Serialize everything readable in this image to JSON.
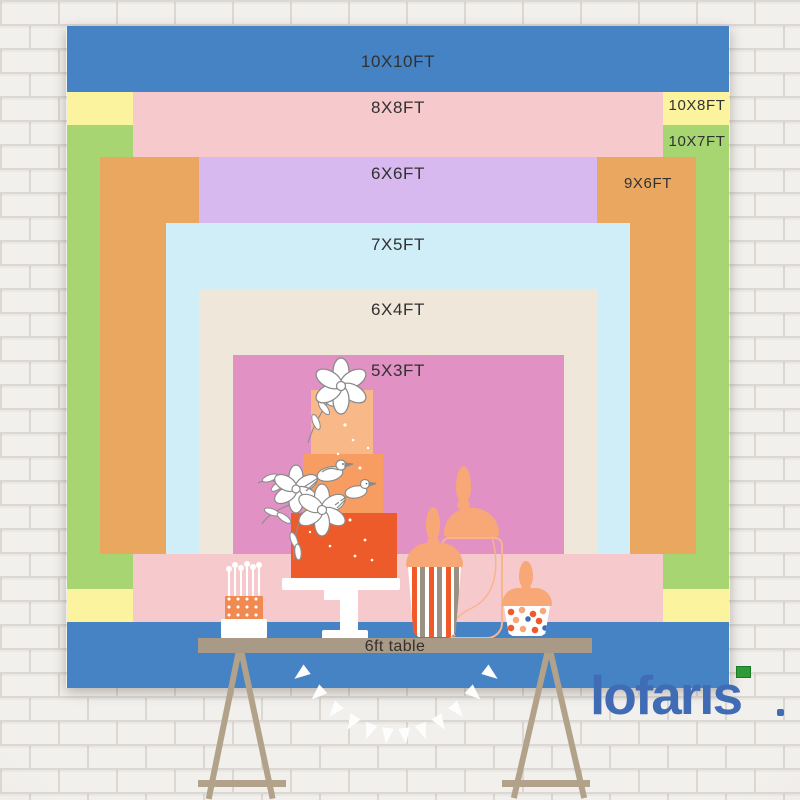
{
  "backdrops": [
    {
      "label": "10X10FT",
      "width_ft": 10,
      "height_ft": 10,
      "color": "#4583c5",
      "v": "center",
      "placement": "center",
      "label_top": 27
    },
    {
      "label": "10X8FT",
      "width_ft": 10,
      "height_ft": 8,
      "color": "#fbf39e",
      "v": "center",
      "placement": "right",
      "label_cx": 631,
      "label_top": 72
    },
    {
      "label": "10X7FT",
      "width_ft": 10,
      "height_ft": 7,
      "color": "#a7d571",
      "v": "center",
      "placement": "right",
      "label_cx": 631,
      "label_top": 108
    },
    {
      "label": "8X8FT",
      "width_ft": 8,
      "height_ft": 8,
      "color": "#f6c9cc",
      "v": "center",
      "placement": "center",
      "label_top": 73
    },
    {
      "label": "9X6FT",
      "width_ft": 9,
      "height_ft": 6,
      "color": "#eaa75f",
      "v": "floor",
      "placement": "right",
      "label_cx": 582,
      "label_top": 150
    },
    {
      "label": "6X6FT",
      "width_ft": 6,
      "height_ft": 6,
      "color": "#d8b9ef",
      "v": "floor",
      "placement": "center",
      "label_top": 139
    },
    {
      "label": "7X5FT",
      "width_ft": 7,
      "height_ft": 5,
      "color": "#cfeef8",
      "v": "floor",
      "placement": "center",
      "label_top": 210
    },
    {
      "label": "6X4FT",
      "width_ft": 6,
      "height_ft": 4,
      "color": "#efe7d9",
      "v": "floor",
      "placement": "center",
      "label_top": 275
    },
    {
      "label": "5X3FT",
      "width_ft": 5,
      "height_ft": 3,
      "color": "#e291c4",
      "v": "floor",
      "placement": "center",
      "label_top": 336
    }
  ],
  "table": {
    "label": "6ft table"
  },
  "brand": {
    "logo_text": "lofaris",
    "logo_color": "#3f6cb5",
    "accent_color": "#2f9b38"
  },
  "colors": {
    "wall_brick": "#f2f0ed",
    "wall_mortar": "#dcd7d2",
    "table_top": "#a89a86",
    "table_legs": "#b2a28a",
    "cake_tier_top": "#f9b888",
    "cake_tier_mid": "#f89d62",
    "cake_tier_bottom": "#ee5b2b",
    "jar_lid_peach": "#f8a777",
    "stripe_orange": "#f05a28",
    "stripe_gray": "#9b9182",
    "label_text": "#313131"
  }
}
